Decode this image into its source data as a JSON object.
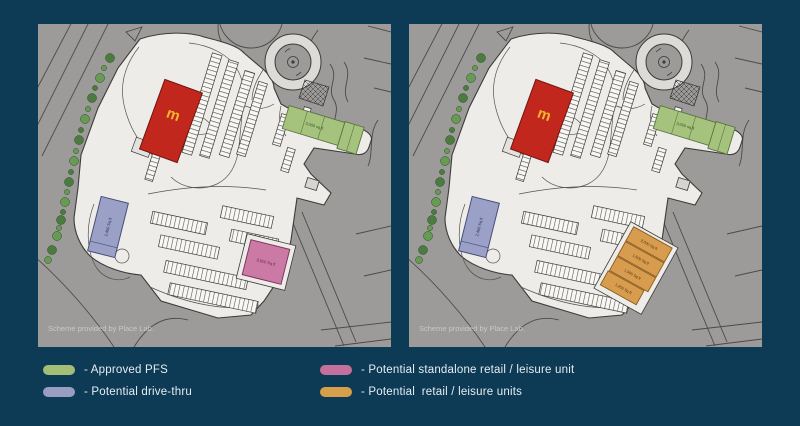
{
  "plan": {
    "attribution": "Scheme provided by Place Lab.",
    "mcdonalds_logo": "m",
    "pfs_label": "3,000 sq ft",
    "drive_thru_label": "2,400 Sq ft",
    "standalone_label": "3,620 Sq ft",
    "retail_units": [
      "2,000 Sq ft",
      "1,500 Sq ft",
      "1,500 Sq ft",
      "1,250 Sq ft"
    ]
  },
  "legend": {
    "items": [
      {
        "label": "- Approved PFS",
        "color": "#a3bd76"
      },
      {
        "label": "- Potential drive-thru",
        "color": "#989dc1"
      },
      {
        "label": "- Potential standalone retail / leisure unit",
        "color": "#c4709c"
      },
      {
        "label": "- Potential  retail / leisure units",
        "color": "#d79f4c"
      }
    ]
  },
  "colors": {
    "background": "#0d3a55",
    "panel_gray": "#9c9b99",
    "site_white": "#edece8",
    "mcdonalds_red": "#c1271d",
    "mcdonalds_yellow": "#f2b72e",
    "pfs_green": "#a6c37e",
    "drive_thru_purple": "#9aa0c6",
    "retail_pink": "#ca7aa5",
    "retail_orange": "#d89c4e",
    "tree_green": "#4c7b40"
  }
}
